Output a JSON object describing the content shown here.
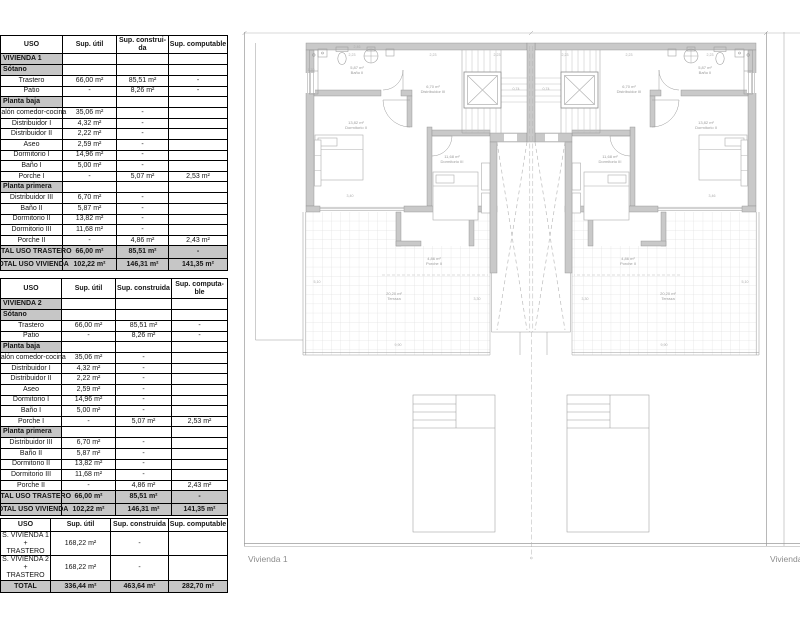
{
  "colors": {
    "wall_fill": "#c9c9c9",
    "wall_stroke": "#8d8d8d",
    "line": "#9b9b9b",
    "light_line": "#c3c3c3",
    "grid": "#d6d6d6",
    "dashed": "#b5b5b5",
    "section_bg": "#c6c6c6",
    "table_border": "#000000",
    "label_gray": "#8c8c8c",
    "dim_gray": "#ababab"
  },
  "tables": [
    {
      "name": "surfaces-vivienda-1",
      "headers": [
        "USO",
        "Sup. útil",
        "Sup. construi-\nda",
        "Sup. computable"
      ],
      "rows": [
        {
          "type": "section",
          "cells": [
            "VIVIENDA 1",
            "",
            "",
            ""
          ]
        },
        {
          "type": "section",
          "cells": [
            "Sótano",
            "",
            "",
            ""
          ]
        },
        {
          "type": "data",
          "cells": [
            "Trastero",
            "66,00 m²",
            "85,51 m²",
            "-"
          ]
        },
        {
          "type": "data",
          "cells": [
            "Patio",
            "-",
            "8,26 m²",
            "-"
          ]
        },
        {
          "type": "section",
          "cells": [
            "Planta baja",
            "",
            "",
            ""
          ]
        },
        {
          "type": "data",
          "cells": [
            "Salón comedor-cocina",
            "35,06 m²",
            "-",
            ""
          ]
        },
        {
          "type": "data",
          "cells": [
            "Distribuidor I",
            "4,32 m²",
            "-",
            ""
          ]
        },
        {
          "type": "data",
          "cells": [
            "Distribuidor II",
            "2,22 m²",
            "-",
            ""
          ]
        },
        {
          "type": "data",
          "cells": [
            "Aseo",
            "2,59 m²",
            "-",
            ""
          ]
        },
        {
          "type": "data",
          "cells": [
            "Dormitorio I",
            "14,96 m²",
            "-",
            ""
          ]
        },
        {
          "type": "data",
          "cells": [
            "Baño I",
            "5,00 m²",
            "-",
            ""
          ]
        },
        {
          "type": "data",
          "cells": [
            "Porche I",
            "-",
            "5,07 m²",
            "2,53 m²"
          ]
        },
        {
          "type": "section",
          "cells": [
            "Planta primera",
            "",
            "",
            ""
          ]
        },
        {
          "type": "data",
          "cells": [
            "Distribuidor III",
            "6,70 m²",
            "-",
            ""
          ]
        },
        {
          "type": "data",
          "cells": [
            "Baño II",
            "5,87 m²",
            "-",
            ""
          ]
        },
        {
          "type": "data",
          "cells": [
            "Dormitorio II",
            "13,82 m²",
            "-",
            ""
          ]
        },
        {
          "type": "data",
          "cells": [
            "Dormitorio III",
            "11,68 m²",
            "-",
            ""
          ]
        },
        {
          "type": "data",
          "cells": [
            "Porche II",
            "-",
            "4,86 m²",
            "2,43 m²"
          ]
        },
        {
          "type": "total",
          "cells": [
            "TOTAL USO TRASTERO",
            "66,00 m²",
            "85,51 m²",
            "-"
          ]
        },
        {
          "type": "total",
          "cells": [
            "TOTAL USO VIVIENDA",
            "102,22 m²",
            "146,31 m²",
            "141,35 m²"
          ]
        }
      ]
    },
    {
      "name": "surfaces-vivienda-2",
      "headers": [
        "USO",
        "Sup. útil",
        "Sup. construida",
        "Sup. computa-\nble"
      ],
      "rows": [
        {
          "type": "section",
          "cells": [
            "VIVIENDA 2",
            "",
            "",
            ""
          ]
        },
        {
          "type": "section",
          "cells": [
            "Sótano",
            "",
            "",
            ""
          ]
        },
        {
          "type": "data",
          "cells": [
            "Trastero",
            "66,00 m²",
            "85,51 m²",
            "-"
          ]
        },
        {
          "type": "data",
          "cells": [
            "Patio",
            "-",
            "8,26 m²",
            "-"
          ]
        },
        {
          "type": "section",
          "cells": [
            "Planta baja",
            "",
            "",
            ""
          ]
        },
        {
          "type": "data",
          "cells": [
            "Salón comedor-cocina",
            "35,06 m²",
            "-",
            ""
          ]
        },
        {
          "type": "data",
          "cells": [
            "Distribuidor I",
            "4,32 m²",
            "-",
            ""
          ]
        },
        {
          "type": "data",
          "cells": [
            "Distribuidor II",
            "2,22 m²",
            "-",
            ""
          ]
        },
        {
          "type": "data",
          "cells": [
            "Aseo",
            "2,59 m²",
            "-",
            ""
          ]
        },
        {
          "type": "data",
          "cells": [
            "Dormitorio I",
            "14,96 m²",
            "-",
            ""
          ]
        },
        {
          "type": "data",
          "cells": [
            "Baño I",
            "5,00 m²",
            "-",
            ""
          ]
        },
        {
          "type": "data",
          "cells": [
            "Porche I",
            "-",
            "5,07 m²",
            "2,53 m²"
          ]
        },
        {
          "type": "section",
          "cells": [
            "Planta primera",
            "",
            "",
            ""
          ]
        },
        {
          "type": "data",
          "cells": [
            "Distribuidor III",
            "6,70 m²",
            "-",
            ""
          ]
        },
        {
          "type": "data",
          "cells": [
            "Baño II",
            "5,87 m²",
            "-",
            ""
          ]
        },
        {
          "type": "data",
          "cells": [
            "Dormitorio II",
            "13,82 m²",
            "-",
            ""
          ]
        },
        {
          "type": "data",
          "cells": [
            "Dormitorio III",
            "11,68 m²",
            "-",
            ""
          ]
        },
        {
          "type": "data",
          "cells": [
            "Porche II",
            "-",
            "4,86 m²",
            "2,43 m²"
          ]
        },
        {
          "type": "total",
          "cells": [
            "TOTAL USO TRASTERO",
            "66,00 m²",
            "85,51 m²",
            "-"
          ]
        },
        {
          "type": "total",
          "cells": [
            "TOTAL USO VIVIENDA",
            "102,22 m²",
            "146,31 m²",
            "141,35 m²"
          ]
        }
      ]
    },
    {
      "name": "surfaces-totals",
      "headers": [
        "USO",
        "Sup. útil",
        "Sup. construida",
        "Sup. computable"
      ],
      "rows": [
        {
          "type": "data",
          "cells": [
            "S. VIVIENDA 1 +\nTRASTERO",
            "168,22 m²",
            "-",
            ""
          ]
        },
        {
          "type": "data",
          "cells": [
            "S. VIVIENDA 2 +\nTRASTERO",
            "168,22 m²",
            "-",
            ""
          ]
        },
        {
          "type": "total",
          "cells": [
            "TOTAL",
            "336,44 m²",
            "463,64 m²",
            "282,70 m²"
          ]
        }
      ]
    }
  ],
  "plan": {
    "unit_labels": [
      {
        "text": "Vivienda 1",
        "x": 248,
        "y": 562
      },
      {
        "text": "Vivienda 2",
        "x": 770,
        "y": 562
      }
    ],
    "room_labels": [
      {
        "text": "5,87 m²",
        "x": 357,
        "y": 69
      },
      {
        "text": "Baño II",
        "x": 357,
        "y": 74
      },
      {
        "text": "6,70 m²",
        "x": 433,
        "y": 88
      },
      {
        "text": "Distribuidor III",
        "x": 433,
        "y": 93
      },
      {
        "text": "13,82 m²",
        "x": 356,
        "y": 124
      },
      {
        "text": "Dormitorio II",
        "x": 356,
        "y": 129
      },
      {
        "text": "11,68 m²",
        "x": 452,
        "y": 158
      },
      {
        "text": "Dormitorio III",
        "x": 452,
        "y": 163
      },
      {
        "text": "4,86 m²",
        "x": 434,
        "y": 260
      },
      {
        "text": "Porche II",
        "x": 434,
        "y": 265
      },
      {
        "text": "20,20 m²",
        "x": 394,
        "y": 295
      },
      {
        "text": "Terraza",
        "x": 394,
        "y": 300
      },
      {
        "text": "5,87 m²",
        "x": 705,
        "y": 69
      },
      {
        "text": "Baño II",
        "x": 705,
        "y": 74
      },
      {
        "text": "6,70 m²",
        "x": 629,
        "y": 88
      },
      {
        "text": "Distribuidor III",
        "x": 629,
        "y": 93
      },
      {
        "text": "13,82 m²",
        "x": 706,
        "y": 124
      },
      {
        "text": "Dormitorio II",
        "x": 706,
        "y": 129
      },
      {
        "text": "11,68 m²",
        "x": 610,
        "y": 158
      },
      {
        "text": "Dormitorio III",
        "x": 610,
        "y": 163
      },
      {
        "text": "4,86 m²",
        "x": 628,
        "y": 260
      },
      {
        "text": "Porche II",
        "x": 628,
        "y": 265
      },
      {
        "text": "20,20 m²",
        "x": 668,
        "y": 295
      },
      {
        "text": "Terraza",
        "x": 668,
        "y": 300
      }
    ],
    "dim_labels": [
      {
        "text": "2,23",
        "x": 352,
        "y": 56
      },
      {
        "text": "2,23",
        "x": 433,
        "y": 56
      },
      {
        "text": "2,23",
        "x": 497,
        "y": 56
      },
      {
        "text": "2,23",
        "x": 565,
        "y": 56
      },
      {
        "text": "2,23",
        "x": 629,
        "y": 56
      },
      {
        "text": "2,23",
        "x": 710,
        "y": 56
      },
      {
        "text": "1,70",
        "x": 311,
        "y": 71
      },
      {
        "text": "2,46",
        "x": 357,
        "y": 48
      },
      {
        "text": "0,74",
        "x": 516,
        "y": 90
      },
      {
        "text": "0,74",
        "x": 546,
        "y": 90
      },
      {
        "text": "3,40",
        "x": 350,
        "y": 197
      },
      {
        "text": "3,46",
        "x": 712,
        "y": 197
      },
      {
        "text": "5,10",
        "x": 317,
        "y": 283
      },
      {
        "text": "5,10",
        "x": 745,
        "y": 283
      },
      {
        "text": "3,30",
        "x": 477,
        "y": 300
      },
      {
        "text": "3,30",
        "x": 585,
        "y": 300
      },
      {
        "text": "9,90",
        "x": 398,
        "y": 346
      },
      {
        "text": "9,90",
        "x": 664,
        "y": 346
      }
    ]
  }
}
